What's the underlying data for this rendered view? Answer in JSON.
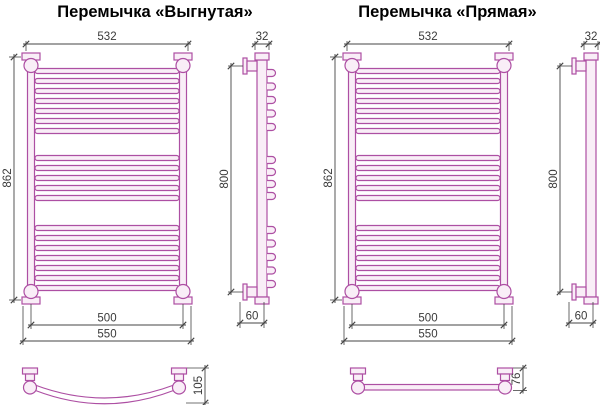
{
  "titles": {
    "left": "Перемычка «Выгнутая»",
    "right": "Перемычка «Прямая»"
  },
  "colors": {
    "background": "#ffffff",
    "pipe_stroke": "#ad4fa3",
    "pipe_fill": "#f9eef7",
    "dim_line": "#444444",
    "dim_text": "#3a3a3a",
    "title_text": "#000000"
  },
  "views": {
    "front": {
      "bar_groups": [
        7,
        5,
        7
      ]
    },
    "side_curved": {
      "loop_groups": [
        5,
        4,
        5
      ]
    },
    "side_straight": {
      "loop_groups": []
    }
  },
  "dimensions": {
    "top_width": "532",
    "front_height": "862",
    "bottom_inner_width": "500",
    "bottom_outer_width": "550",
    "side_top_width": "32",
    "side_height": "800",
    "side_bottom_depth": "60",
    "curved_bar_depth": "105",
    "straight_bar_depth": "76"
  }
}
